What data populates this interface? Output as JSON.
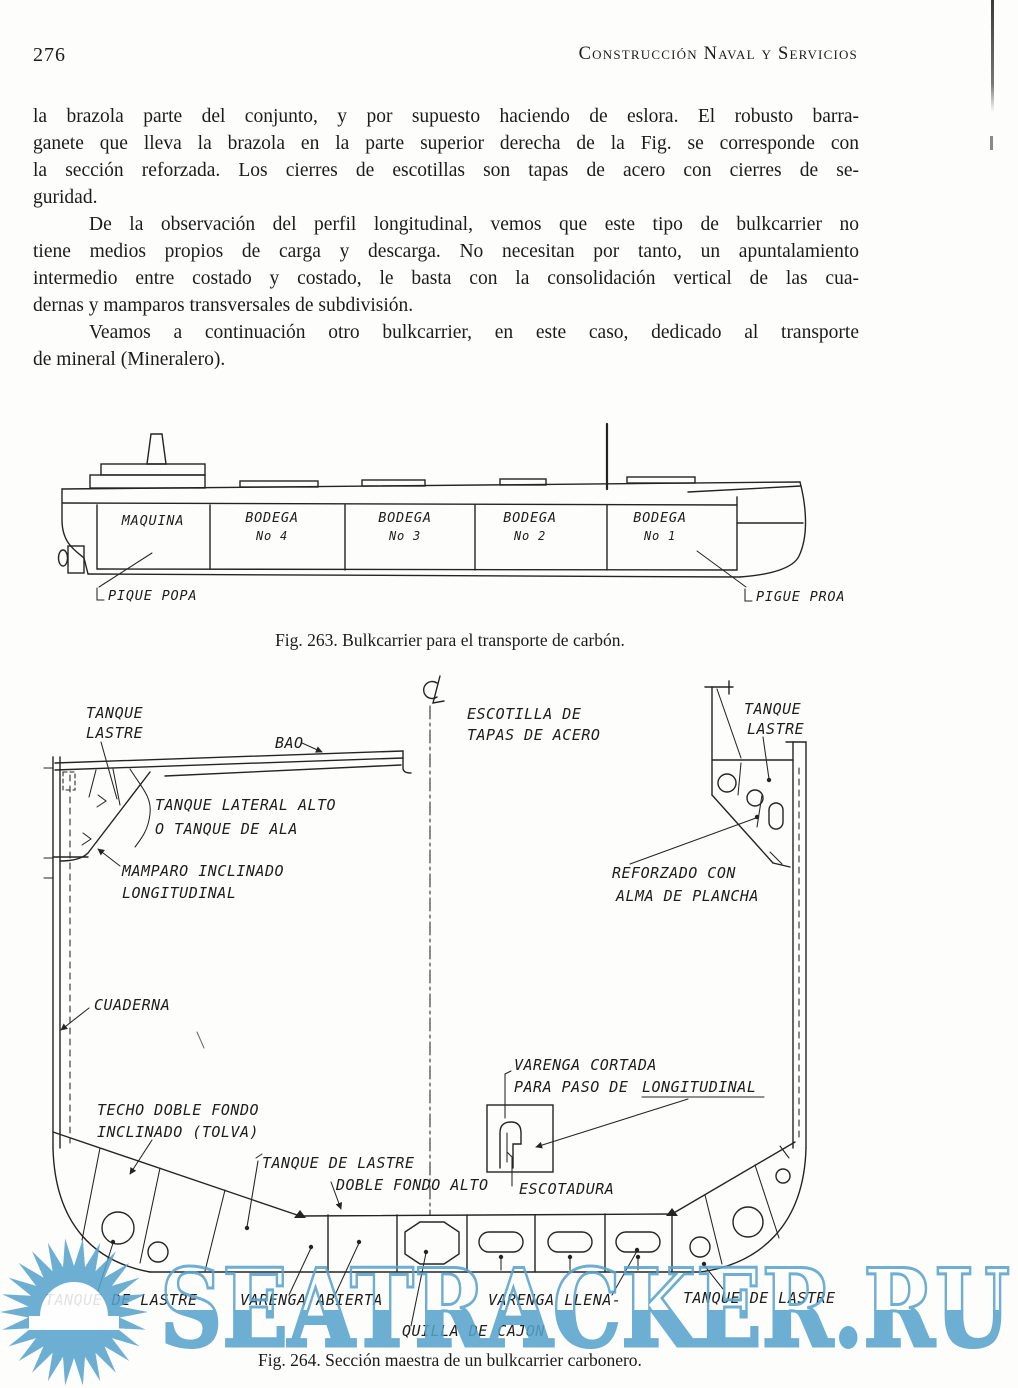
{
  "header": {
    "page_number": "276",
    "title": "Construcción Naval y Servicios"
  },
  "paragraphs": [
    {
      "lines": [
        "la brazola parte del conjunto, y por supuesto haciendo de eslora. El robusto barra-",
        "ganete que lleva la brazola en la parte superior derecha de la Fig. se corresponde con",
        "la sección reforzada. Los cierres de escotillas son tapas de acero con cierres de se-",
        "guridad."
      ]
    },
    {
      "lines": [
        "De la observación del perfil longitudinal, vemos que este tipo de bulkcarrier no",
        "tiene medios propios de carga y descarga. No necesitan por tanto, un apuntalamiento",
        "intermedio entre costado y costado, le basta con la consolidación vertical de las cua-",
        "dernas y mamparos transversales de subdivisión."
      ]
    },
    {
      "lines": [
        "Veamos a continuación otro bulkcarrier, en este caso, dedicado al transporte",
        "de mineral (Mineralero)."
      ]
    }
  ],
  "fig263": {
    "caption": "Fig. 263. Bulkcarrier para el transporte de carbón.",
    "labels": {
      "maquina": "MAQUINA",
      "b4": [
        "BODEGA",
        "No 4"
      ],
      "b3": [
        "BODEGA",
        "No 3"
      ],
      "b2": [
        "BODEGA",
        "No 2"
      ],
      "b1": [
        "BODEGA",
        "No 1"
      ],
      "pique_popa": "PIQUE POPA",
      "pique_proa": "PIGUE PROA"
    }
  },
  "fig264": {
    "caption": "Fig. 264. Sección maestra de un bulkcarrier carbonero.",
    "labels": {
      "tanque_lastre_l": [
        "TANQUE",
        "LASTRE"
      ],
      "bao": "BAO",
      "escotilla": [
        "ESCOTILLA DE",
        "TAPAS DE ACERO"
      ],
      "tanque_lastre_r": [
        "TANQUE",
        "LASTRE"
      ],
      "lateral": [
        "TANQUE LATERAL ALTO",
        "O TANQUE DE ALA"
      ],
      "mamparo": [
        "MAMPARO INCLINADO",
        "LONGITUDINAL"
      ],
      "reforzado": [
        "REFORZADO CON",
        "ALMA DE PLANCHA"
      ],
      "cuaderna": "CUADERNA",
      "varenga_cortada": [
        "VARENGA CORTADA",
        "PARA PASO DE",
        "LONGITUDINAL"
      ],
      "techo": [
        "TECHO DOBLE FONDO",
        "INCLINADO (TOLVA)"
      ],
      "tanque_lastre_mid": "TANQUE DE LASTRE",
      "doble_fondo": "DOBLE FONDO ALTO",
      "escotadura": "ESCOTADURA",
      "tanque_lastre_bl": "TANQUE DE LASTRE",
      "varenga_abierta": "VARENGA ABIERTA",
      "quilla": "QUILLA DE CAJON",
      "varenga_llena": "VARENGA LLENA-",
      "tanque_lastre_br": "TANQUE DE LASTRE"
    }
  },
  "watermark": {
    "text": "SEATRACKER.RU",
    "color": "#58a3cd"
  }
}
